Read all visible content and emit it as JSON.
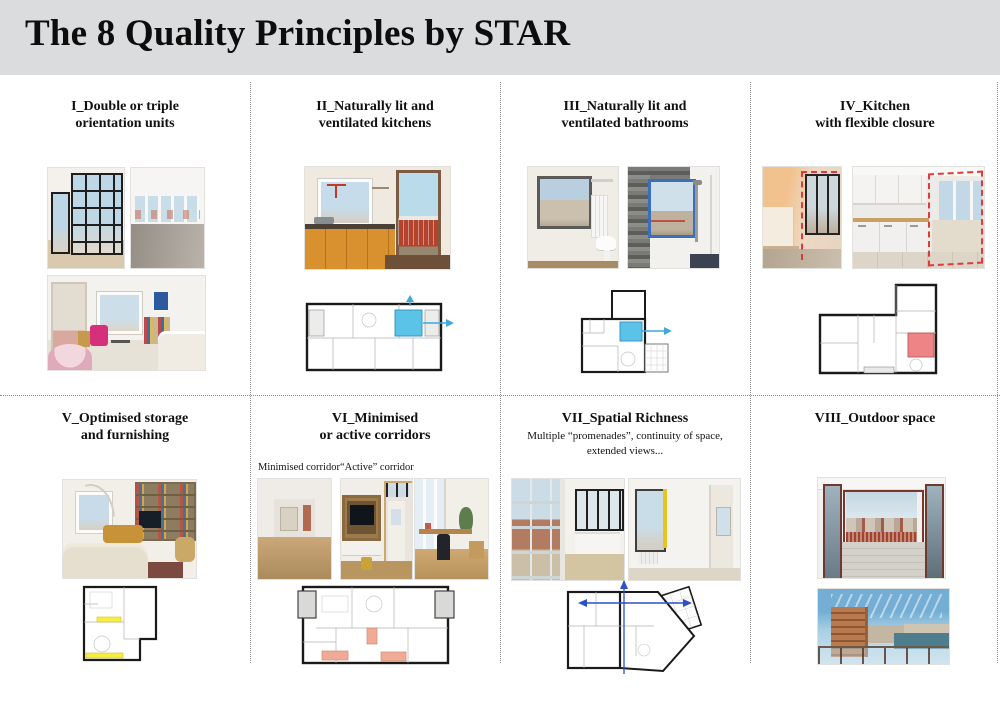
{
  "header": {
    "title": "The 8 Quality Principles by STAR"
  },
  "panels": [
    {
      "id": "I",
      "title1": "I_Double or triple",
      "title2": "orientation units"
    },
    {
      "id": "II",
      "title1": "II_Naturally lit and",
      "title2": "ventilated kitchens"
    },
    {
      "id": "III",
      "title1": "III_Naturally lit and",
      "title2": "ventilated bathrooms"
    },
    {
      "id": "IV",
      "title1": "IV_Kitchen",
      "title2": "with flexible closure"
    },
    {
      "id": "V",
      "title1": "V_Optimised storage",
      "title2": "and furnishing"
    },
    {
      "id": "VI",
      "title1": "VI_Minimised",
      "title2": "or active corridors",
      "label_left": "Minimised corridor",
      "label_right": "“Active” corridor"
    },
    {
      "id": "VII",
      "title1": "VII_Spatial Richness",
      "subtitle": "Multiple “promenades”, continuity of space, extended views..."
    },
    {
      "id": "VIII",
      "title1": "VIII_Outdoor space"
    }
  ],
  "colors": {
    "header_bg": "#dbdcdd",
    "title_text": "#0d0d0d",
    "divider": "#8f8f8f",
    "highlight_blue": "#5bc3e8",
    "highlight_red": "#ee8486",
    "highlight_yellow": "#f8ee3e",
    "highlight_salmon": "#f0ab96",
    "arrow_cyan": "#3fa9dc",
    "arrow_blue": "#2b50c8",
    "dashed_red": "#e03b3b"
  }
}
